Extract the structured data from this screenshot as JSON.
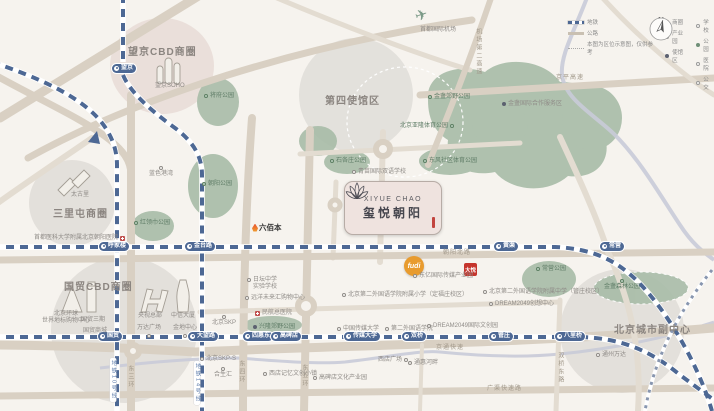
{
  "project": {
    "name_en": "XIYUE CHAO",
    "name_cn": "玺悦朝阳"
  },
  "airport": {
    "label": "首都国际机场"
  },
  "compass": "N",
  "districts": [
    {
      "label": "望京CBD商圈",
      "x": 128,
      "y": 47
    },
    {
      "label": "三里屯商圈",
      "x": 53,
      "y": 209
    },
    {
      "label": "国贸CBD商圈",
      "x": 64,
      "y": 282
    },
    {
      "label": "第四使馆区",
      "x": 325,
      "y": 96
    },
    {
      "label": "北京城市副中心",
      "x": 614,
      "y": 325
    }
  ],
  "stations": [
    {
      "label": "望京",
      "x": 112,
      "y": 64
    },
    {
      "label": "呼家楼",
      "x": 99,
      "y": 242
    },
    {
      "label": "金台路",
      "x": 185,
      "y": 242
    },
    {
      "label": "黄渠",
      "x": 494,
      "y": 242
    },
    {
      "label": "常营",
      "x": 600,
      "y": 242
    },
    {
      "label": "国贸",
      "x": 98,
      "y": 332
    },
    {
      "label": "大望路",
      "x": 188,
      "y": 332
    },
    {
      "label": "四惠东",
      "x": 243,
      "y": 332
    },
    {
      "label": "高碑店",
      "x": 271,
      "y": 332
    },
    {
      "label": "传媒大学",
      "x": 344,
      "y": 332
    },
    {
      "label": "双桥",
      "x": 402,
      "y": 332
    },
    {
      "label": "管庄",
      "x": 489,
      "y": 332
    },
    {
      "label": "八里桥",
      "x": 555,
      "y": 332
    }
  ],
  "parks": [
    {
      "label": "将府公园",
      "x": 204,
      "y": 93,
      "icon": "green",
      "pos": "left"
    },
    {
      "label": "朝阳公园",
      "x": 202,
      "y": 181,
      "icon": "green",
      "pos": "left"
    },
    {
      "label": "红领巾公园",
      "x": 134,
      "y": 220,
      "icon": "green",
      "pos": "left"
    },
    {
      "label": "石各庄公园",
      "x": 330,
      "y": 158,
      "icon": "green",
      "pos": "left"
    },
    {
      "label": "东风社区体育公园",
      "x": 423,
      "y": 158,
      "icon": "green",
      "pos": "left"
    },
    {
      "label": "金盏郊野公园",
      "x": 428,
      "y": 94,
      "icon": "green",
      "pos": "left"
    },
    {
      "label": "北京亚隆体育公园",
      "x": 400,
      "y": 123,
      "icon": "green",
      "pos": "right"
    },
    {
      "label": "常营公园",
      "x": 536,
      "y": 266,
      "icon": "green",
      "pos": "left"
    },
    {
      "label": "金盏森林公园",
      "x": 604,
      "y": 278,
      "icon": "green",
      "pos": "top"
    },
    {
      "label": "兴隆郊野公园",
      "x": 253,
      "y": 324,
      "icon": "dark",
      "pos": "left"
    }
  ],
  "pois": [
    {
      "label": "蓝色港湾",
      "x": 149,
      "y": 165,
      "icon": "o",
      "pos": "top"
    },
    {
      "label": "望京SOHO",
      "x": 155,
      "y": 83,
      "icon": "none",
      "pos": "left"
    },
    {
      "label": "太古里",
      "x": 71,
      "y": 192,
      "icon": "none",
      "pos": "left"
    },
    {
      "label": "首都医科大学附属北京朝阳医院",
      "x": 34,
      "y": 235,
      "icon": "cross",
      "pos": "right"
    },
    {
      "label": "北京环球\n世界地标购物中心",
      "x": 42,
      "y": 311,
      "icon": "none",
      "pos": "center"
    },
    {
      "label": "国贸三期",
      "x": 81,
      "y": 317,
      "icon": "none",
      "pos": "left"
    },
    {
      "label": "国贸商城",
      "x": 83,
      "y": 328,
      "icon": "none",
      "pos": "left"
    },
    {
      "label": "央视总部",
      "x": 138,
      "y": 313,
      "icon": "none",
      "pos": "left"
    },
    {
      "label": "万达广场",
      "x": 137,
      "y": 325,
      "icon": "o",
      "pos": "bottom"
    },
    {
      "label": "中信大厦",
      "x": 171,
      "y": 313,
      "icon": "none",
      "pos": "left"
    },
    {
      "label": "金地中心",
      "x": 173,
      "y": 325,
      "icon": "o",
      "pos": "bottom"
    },
    {
      "label": "北京SKP",
      "x": 212,
      "y": 314,
      "icon": "o",
      "pos": "top"
    },
    {
      "label": "北京SKP-S",
      "x": 200,
      "y": 356,
      "icon": "oo",
      "pos": "left"
    },
    {
      "label": "合生汇",
      "x": 214,
      "y": 366,
      "icon": "o",
      "pos": "top"
    },
    {
      "label": "日坛中学\n实验学校",
      "x": 247,
      "y": 277,
      "icon": "o",
      "pos": "left"
    },
    {
      "label": "远洋未来汇购物中心",
      "x": 245,
      "y": 295,
      "icon": "o",
      "pos": "left"
    },
    {
      "label": "民航总医院",
      "x": 255,
      "y": 310,
      "icon": "cross",
      "pos": "left"
    },
    {
      "label": "西店记忆文创小镇",
      "x": 263,
      "y": 371,
      "icon": "o",
      "pos": "left"
    },
    {
      "label": "高碑店文化产业园",
      "x": 313,
      "y": 375,
      "icon": "o",
      "pos": "left"
    },
    {
      "label": "西店广场",
      "x": 378,
      "y": 357,
      "icon": "o",
      "pos": "right"
    },
    {
      "label": "通惠河畔",
      "x": 408,
      "y": 360,
      "icon": "oo",
      "pos": "left"
    },
    {
      "label": "中国传媒大学",
      "x": 337,
      "y": 326,
      "icon": "o",
      "pos": "left"
    },
    {
      "label": "第二外国语学院",
      "x": 385,
      "y": 326,
      "icon": "o",
      "pos": "left"
    },
    {
      "label": "DREAM2049国际文创园",
      "x": 427,
      "y": 323,
      "icon": "oo",
      "pos": "left"
    },
    {
      "label": "东亿国际传媒产业园",
      "x": 413,
      "y": 273,
      "icon": "o",
      "pos": "left"
    },
    {
      "label": "北京第二外国语学院附属小学（定福庄校区）",
      "x": 342,
      "y": 292,
      "icon": "o",
      "pos": "left"
    },
    {
      "label": "北京第二外国语学院附属中学（管庄校区）",
      "x": 483,
      "y": 289,
      "icon": "o",
      "pos": "left"
    },
    {
      "label": "DREAM2049创想中心",
      "x": 489,
      "y": 301,
      "icon": "oo",
      "pos": "left"
    },
    {
      "label": "通州万达",
      "x": 596,
      "y": 352,
      "icon": "o",
      "pos": "left"
    },
    {
      "label": "青苗国际双语学校",
      "x": 352,
      "y": 169,
      "icon": "o",
      "pos": "left"
    },
    {
      "label": "金盏国际合作服务区",
      "x": 502,
      "y": 101,
      "icon": "dark",
      "pos": "left"
    }
  ],
  "roadLabels": [
    {
      "label": "京平高速",
      "x": 556,
      "y": 75,
      "v": false,
      "metro": false
    },
    {
      "label": "机场第二高速",
      "x": 474,
      "y": 28,
      "v": true,
      "metro": false
    },
    {
      "label": "东三环",
      "x": 126,
      "y": 365,
      "v": true,
      "metro": false
    },
    {
      "label": "东四环",
      "x": 237,
      "y": 360,
      "v": true,
      "metro": false
    },
    {
      "label": "东五环",
      "x": 300,
      "y": 364,
      "v": true,
      "metro": false
    },
    {
      "label": "地铁10号线",
      "x": 110,
      "y": 358,
      "v": true,
      "metro": true
    },
    {
      "label": "地铁14号线",
      "x": 194,
      "y": 361,
      "v": true,
      "metro": true
    },
    {
      "label": "京通快速",
      "x": 436,
      "y": 345,
      "v": false,
      "metro": false
    },
    {
      "label": "双桥东路",
      "x": 556,
      "y": 352,
      "v": true,
      "metro": false
    },
    {
      "label": "广渠快速路",
      "x": 487,
      "y": 386,
      "v": false,
      "metro": false
    },
    {
      "label": "朝阳北路",
      "x": 443,
      "y": 250,
      "v": false,
      "metro": false
    }
  ],
  "badges": {
    "fudi": "fudi",
    "liubaiben": "六佰本",
    "dayue": "大悦"
  },
  "legend": {
    "lines": [
      {
        "type": "metro",
        "label": "地铁"
      },
      {
        "type": "road",
        "label": "公路"
      },
      {
        "type": "note",
        "label": "本图为区位示意图，仅供参考"
      }
    ],
    "col1": [
      {
        "type": "filled-red",
        "label": "商圈"
      },
      {
        "type": "outline",
        "label": "产业园"
      },
      {
        "type": "filled-dark",
        "label": "使馆区"
      }
    ],
    "col2": [
      {
        "type": "outline",
        "label": "学校"
      },
      {
        "type": "filled-green",
        "label": "公园"
      },
      {
        "type": "outline",
        "label": "医院"
      },
      {
        "type": "outline",
        "label": "公交"
      }
    ]
  }
}
